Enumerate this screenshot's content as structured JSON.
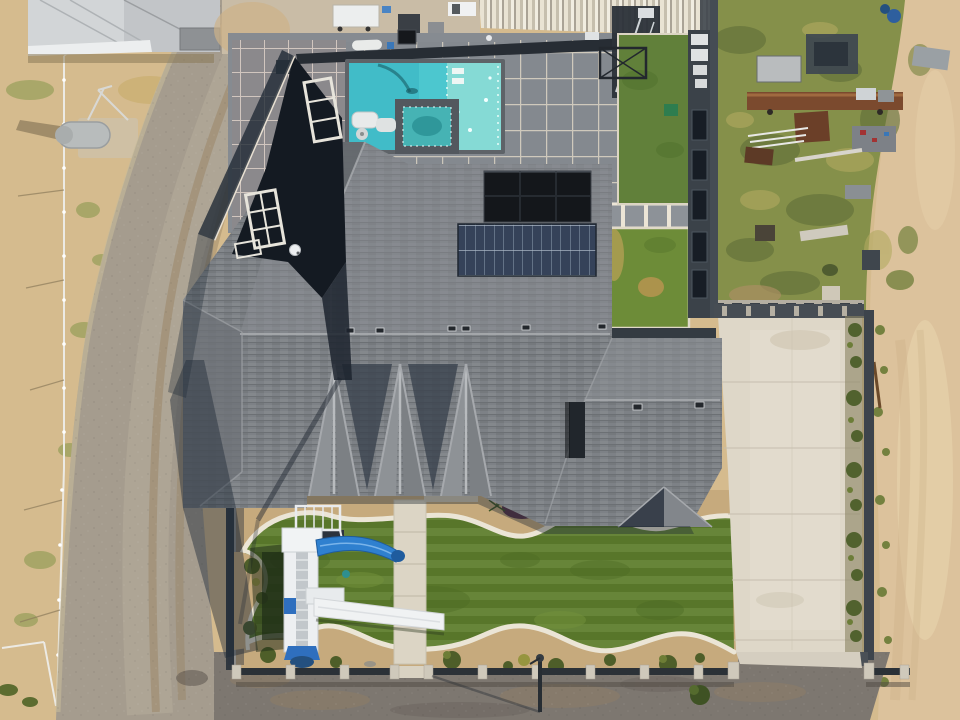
{
  "meta": {
    "title": "Aerial drone photograph of a residential property",
    "image_type": "photograph",
    "width_px": 960,
    "height_px": 720,
    "view": "top-down overhead"
  },
  "palette": {
    "sand_field": "#d5bb8e",
    "desert_sand": "#dcc29c",
    "gravel_road": "#a59c8e",
    "street_gravel": "#7d7770",
    "roof_shingle_gray": "#7d8186",
    "roof_ridge_light": "#a9acaf",
    "shadow_navy": "#1d2733",
    "solar_panel_dark": "#14171b",
    "solar_panel_blue_grid": "#354259",
    "pool_water_turquoise": "#4cc7cf",
    "pool_ledge_aqua": "#85dad5",
    "spa_water_teal": "#46b3b4",
    "pool_deck_slate": "#868b91",
    "paver_grout_white": "#d7d0c2",
    "lawn_green": "#5d7d2d",
    "ne_lawn_green": "#61803a",
    "junkyard_foliage": "#85904a",
    "rust_brown": "#7b4a2e",
    "driveway_concrete": "#ded7c8",
    "walkway_concrete": "#dcd5c5",
    "play_structure_white": "#edeff1",
    "water_slide_blue": "#2f80cf",
    "dark_wall": "#3b4249",
    "fence_white": "#eceae4",
    "barn_roof_gray": "#c2c5c8",
    "front_wall_post": "#cfc9bb"
  },
  "scene": {
    "counts": {
      "solar_arrays": 2,
      "gable_peaks": 3,
      "lawn_panels_north": 2,
      "slides_on_play_tower": 2
    },
    "property": [
      {
        "name": "main-house-roof",
        "description": "large charcoal-gray shingled hip-and-gable roof with three gable peaks and a pyramid dormer"
      },
      {
        "name": "solar-array-dark",
        "description": "black solar panel array on upper roof slope"
      },
      {
        "name": "solar-array-grid",
        "description": "blue-gray gridded solar array below the black array"
      },
      {
        "name": "swimming-pool",
        "description": "rectangular turquoise pool with inset square spa and pale tanning ledge"
      },
      {
        "name": "pool-deck",
        "description": "gray slate paver deck with white grout grid bands"
      },
      {
        "name": "patio-cover",
        "description": "corrugated light-tan metal cover at top edge of parcel"
      },
      {
        "name": "north-lawns",
        "description": "two rectangular artificial-turf lawn panels framed by white paver grids"
      },
      {
        "name": "entry-courtyard",
        "description": "dark recessed entry with white-trimmed windows along diagonal wall"
      },
      {
        "name": "backyard-lawn",
        "description": "large green lawn with wavy white concrete mow-strip borders"
      },
      {
        "name": "play-tower",
        "description": "white play tower with ladder, blue curved water slide and white straight slide"
      },
      {
        "name": "walkway",
        "description": "light concrete walkway from house through lawn to front wall"
      },
      {
        "name": "driveway",
        "description": "wide light concrete driveway running to the street"
      },
      {
        "name": "front-wall",
        "description": "low wall with concrete posts and dark rails along the street"
      },
      {
        "name": "lamp-post",
        "description": "street lamp at center of front street"
      }
    ],
    "surroundings": [
      {
        "name": "dirt-field",
        "description": "dry sandy paddock with white pipe fence on the left"
      },
      {
        "name": "water-tank",
        "description": "gray horizontal tank on concrete pad in left field"
      },
      {
        "name": "metal-barn",
        "description": "gray metal-roof outbuilding at top-left corner"
      },
      {
        "name": "neighbor-pad",
        "description": "concrete pad with white trailer and equipment at top edge"
      },
      {
        "name": "gravel-road",
        "description": "curving gravel drive with brown tire tracks along the west side"
      },
      {
        "name": "junk-yard",
        "description": "overgrown neighboring lot full of rusty trailers, barrels and scrap"
      },
      {
        "name": "desert-strip",
        "description": "bare tan desert sand along the right edge"
      },
      {
        "name": "street",
        "description": "dark gravel street across the bottom edge"
      }
    ]
  }
}
